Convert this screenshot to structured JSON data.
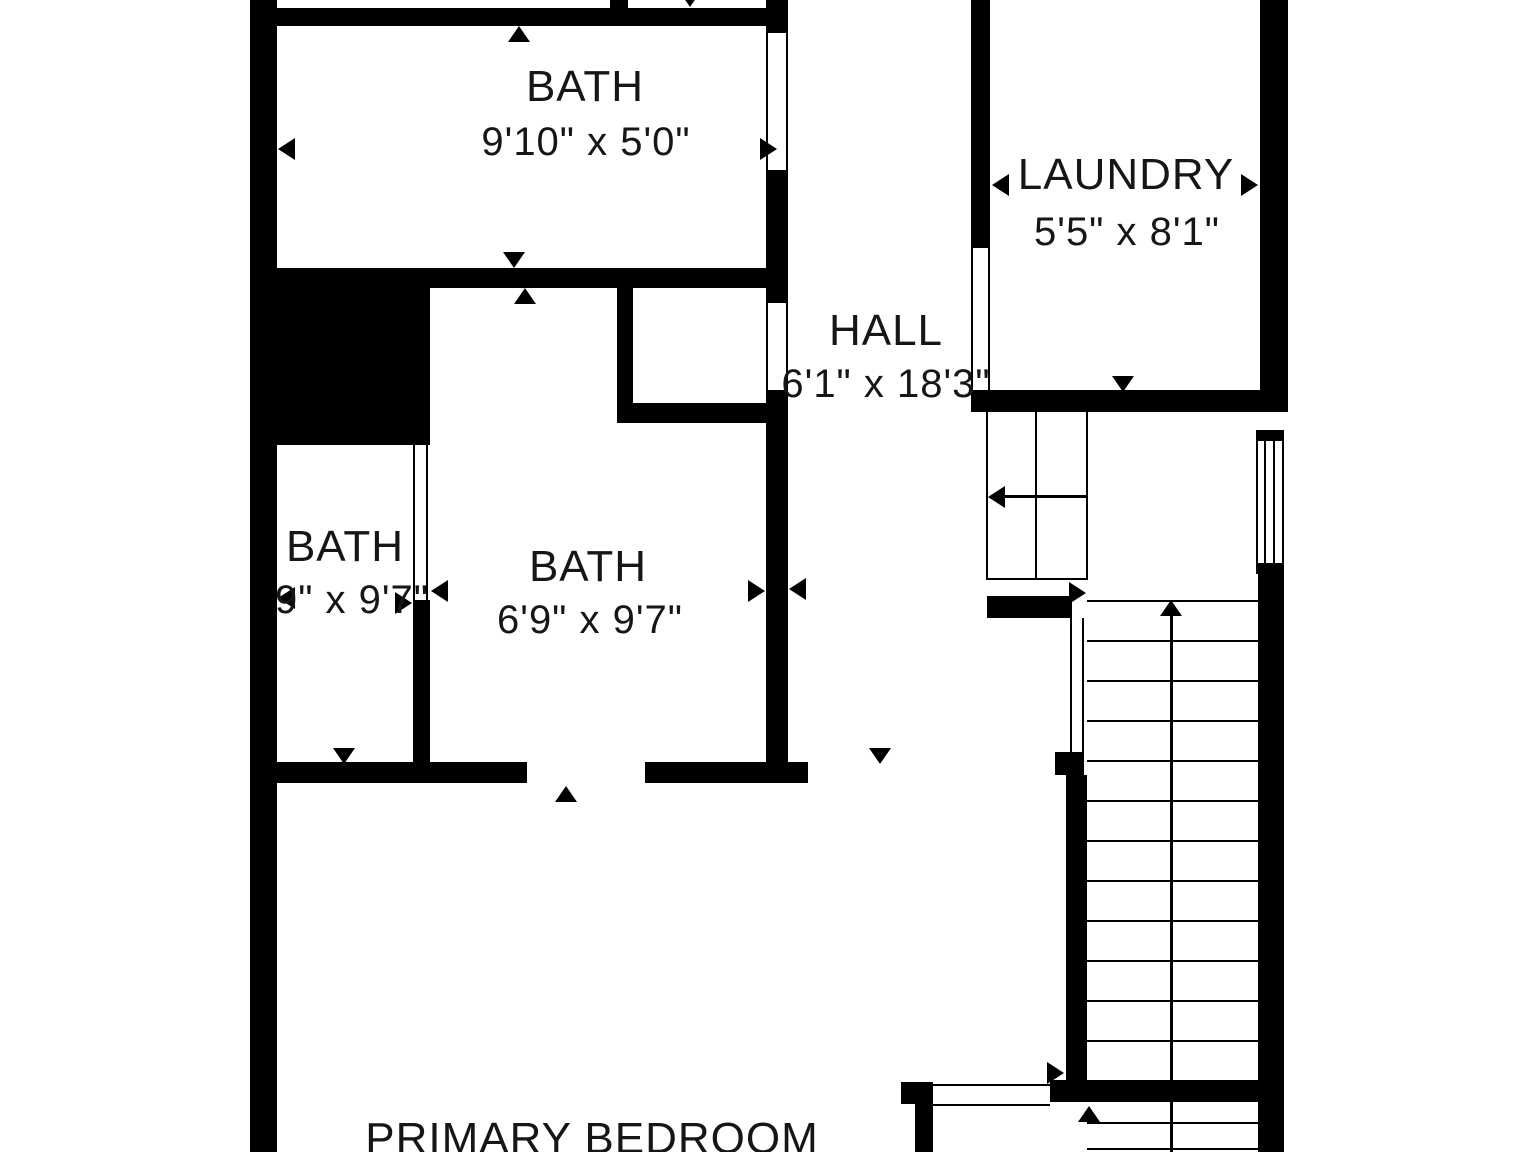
{
  "floorplan": {
    "rooms": {
      "bath_top": {
        "label": "BATH",
        "dims": "9'10\" x 5'0\""
      },
      "laundry": {
        "label": "LAUNDRY",
        "dims": "5'5\" x 8'1\""
      },
      "hall": {
        "label": "HALL",
        "dims": "6'1\" x 18'3\""
      },
      "bath_left": {
        "label": "BATH",
        "dims": "9\" x 9'7\""
      },
      "bath_mid": {
        "label": "BATH",
        "dims": "6'9\" x 9'7\""
      },
      "primary_bedroom": {
        "label": "PRIMARY BEDROOM"
      }
    },
    "colors": {
      "wall": "#000000",
      "background": "#ffffff",
      "text": "#161616"
    }
  }
}
